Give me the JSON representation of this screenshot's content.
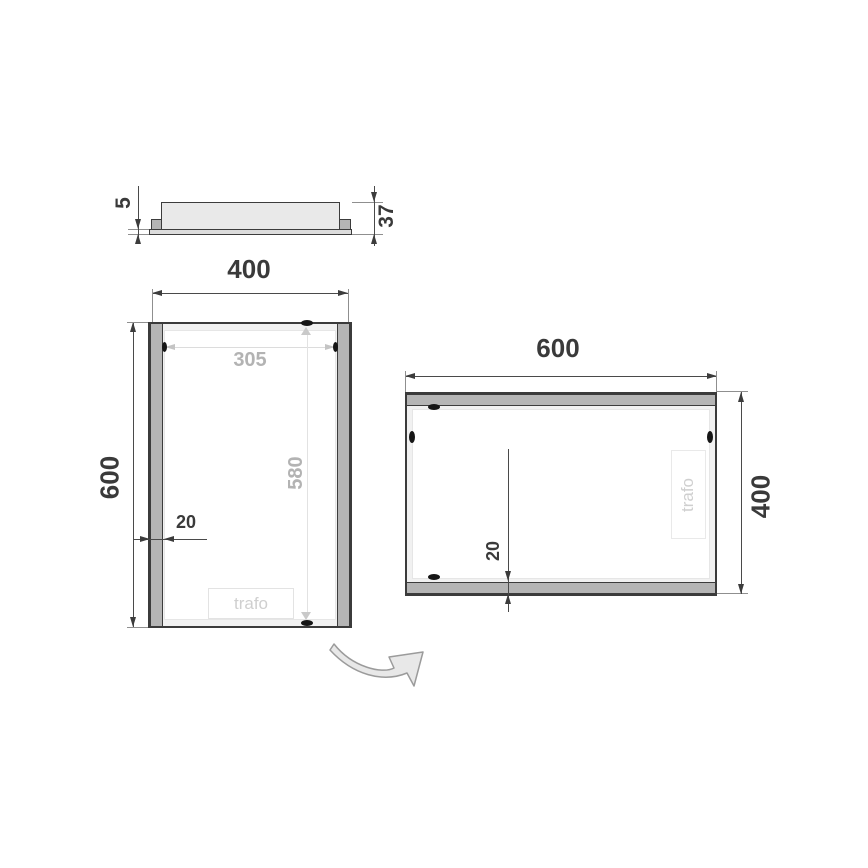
{
  "colors": {
    "outline": "#3c3c3c",
    "metal_gray": "#b5b5b5",
    "panel_gray": "#e9e9e9",
    "dim_dark": "#3a3a3a",
    "dim_light": "#b3b3b3",
    "trafo_text": "#cfcfcf"
  },
  "profile": {
    "glass_thickness": "5",
    "depth": "37"
  },
  "portrait": {
    "width": "400",
    "height": "600",
    "inner_width": "305",
    "inner_height": "580",
    "frame_width": "20",
    "trafo_label": "trafo"
  },
  "landscape": {
    "width": "600",
    "height": "400",
    "frame_width": "20",
    "trafo_label": "trafo"
  },
  "icons": {
    "rotation_arrow": "curved-rotate-arrow"
  }
}
